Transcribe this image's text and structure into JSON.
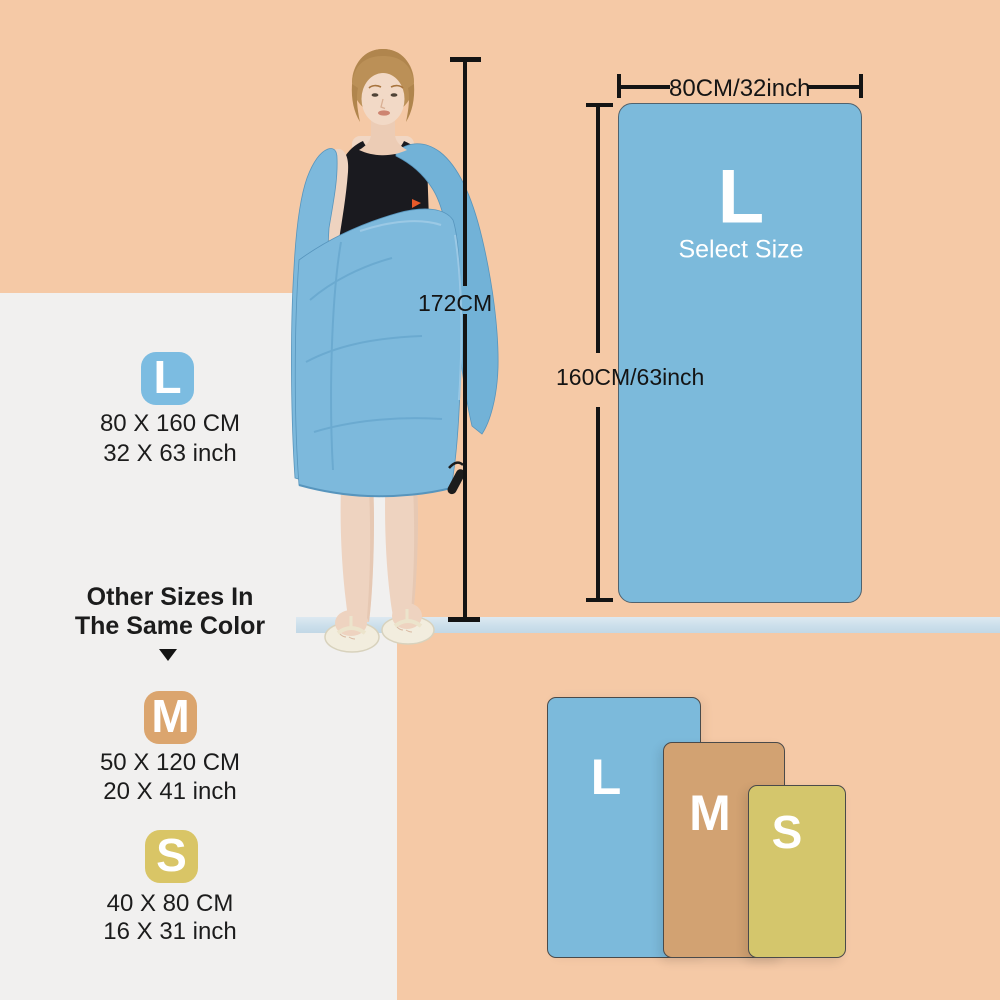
{
  "colors": {
    "background_peach": "#f5c9a6",
    "panel_white": "#f1f0ef",
    "shelf_strip_blue": "#cfe1ec",
    "towel_blue": "#7cbadb",
    "towel_tan": "#d2a272",
    "towel_gold": "#d4c66c",
    "badge_blue": "#7cbce1",
    "badge_tan": "#dba56e",
    "badge_gold": "#d9c566",
    "annotation_line_black": "#141414",
    "text_black": "#1c1c1c",
    "letter_white": "#ffffff"
  },
  "legend": {
    "size_l": {
      "letter": "L",
      "cm": "80 X 160 CM",
      "inch": "32 X 63 inch"
    },
    "heading_line1": "Other Sizes In",
    "heading_line2": "The Same Color",
    "size_m": {
      "letter": "M",
      "cm": "50 X 120 CM",
      "inch": "20 X 41 inch"
    },
    "size_s": {
      "letter": "S",
      "cm": "40 X 80 CM",
      "inch": "16 X 31 inch"
    }
  },
  "model_figure": {
    "height_label": "172CM"
  },
  "size_diagram": {
    "letter": "L",
    "subtitle": "Select Size",
    "width_label": "80CM/32inch",
    "height_label": "160CM/63inch"
  },
  "size_comparison": {
    "large": "L",
    "medium": "M",
    "small": "S"
  }
}
